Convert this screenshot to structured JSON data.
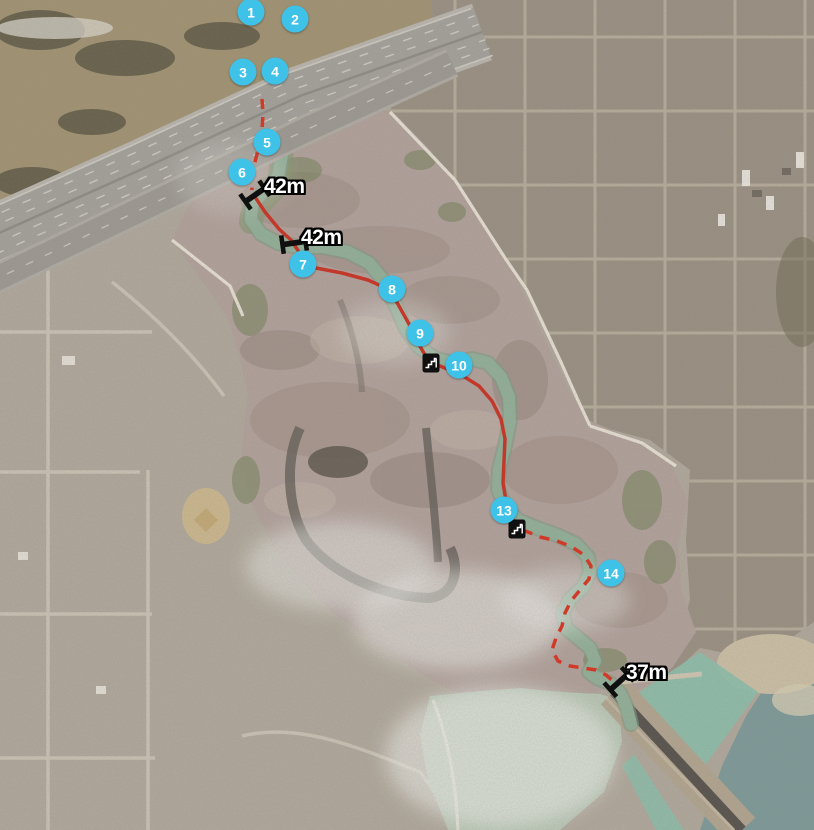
{
  "colors": {
    "marker_fill": "#3fc2e8",
    "marker_text": "#ffffff",
    "route_solid": "#c2392c",
    "route_dashed": "#d03a28",
    "distance_text": "#ffffff",
    "distance_outline": "#000000",
    "poi_icon": "#101010"
  },
  "markers": [
    {
      "label": "1",
      "x": 251,
      "y": 12
    },
    {
      "label": "2",
      "x": 295,
      "y": 19
    },
    {
      "label": "3",
      "x": 243,
      "y": 72
    },
    {
      "label": "4",
      "x": 275,
      "y": 71
    },
    {
      "label": "5",
      "x": 267,
      "y": 142
    },
    {
      "label": "6",
      "x": 242,
      "y": 172
    },
    {
      "label": "7",
      "x": 303,
      "y": 264
    },
    {
      "label": "8",
      "x": 392,
      "y": 289
    },
    {
      "label": "9",
      "x": 420,
      "y": 333
    },
    {
      "label": "10",
      "x": 459,
      "y": 365
    },
    {
      "label": "13",
      "x": 504,
      "y": 510
    },
    {
      "label": "14",
      "x": 611,
      "y": 573
    }
  ],
  "distance_labels": [
    {
      "label": "42m",
      "icon": "bridge-icon",
      "x": 255,
      "y": 195,
      "rotation": -35,
      "label_dx": 9,
      "label_dy": -20
    },
    {
      "label": "42m",
      "icon": "bridge-icon",
      "x": 294,
      "y": 243,
      "rotation": -8,
      "label_dx": 7,
      "label_dy": -17
    },
    {
      "label": "37m",
      "icon": "bridge-icon",
      "x": 619,
      "y": 682,
      "rotation": -42,
      "label_dx": 7,
      "label_dy": -21
    }
  ],
  "poi_icons": [
    {
      "name": "stairs-icon",
      "x": 431,
      "y": 363
    },
    {
      "name": "stairs-icon",
      "x": 517,
      "y": 529
    }
  ],
  "routes": {
    "solid": [
      [
        255,
        197
      ],
      [
        265,
        212
      ],
      [
        279,
        229
      ],
      [
        291,
        240
      ],
      [
        299,
        252
      ],
      [
        303,
        262
      ],
      [
        316,
        268
      ],
      [
        342,
        273
      ],
      [
        368,
        280
      ],
      [
        390,
        290
      ],
      [
        399,
        306
      ],
      [
        409,
        324
      ],
      [
        417,
        341
      ],
      [
        425,
        355
      ],
      [
        433,
        363
      ],
      [
        447,
        369
      ],
      [
        463,
        376
      ],
      [
        479,
        386
      ],
      [
        492,
        401
      ],
      [
        501,
        419
      ],
      [
        505,
        439
      ],
      [
        504,
        461
      ],
      [
        503,
        483
      ],
      [
        506,
        501
      ],
      [
        511,
        516
      ],
      [
        517,
        527
      ]
    ],
    "dashed": [
      [
        [
          262,
          99
        ],
        [
          263,
          114
        ],
        [
          262,
          130
        ],
        [
          259,
          146
        ],
        [
          255,
          162
        ],
        [
          251,
          177
        ],
        [
          252,
          190
        ]
      ],
      [
        [
          523,
          530
        ],
        [
          540,
          537
        ],
        [
          557,
          541
        ],
        [
          572,
          547
        ],
        [
          584,
          555
        ],
        [
          591,
          566
        ],
        [
          589,
          579
        ],
        [
          580,
          590
        ],
        [
          571,
          601
        ],
        [
          565,
          613
        ],
        [
          562,
          626
        ],
        [
          556,
          638
        ],
        [
          552,
          650
        ],
        [
          558,
          661
        ],
        [
          570,
          666
        ],
        [
          583,
          668
        ],
        [
          596,
          670
        ],
        [
          606,
          675
        ],
        [
          613,
          681
        ]
      ]
    ]
  }
}
